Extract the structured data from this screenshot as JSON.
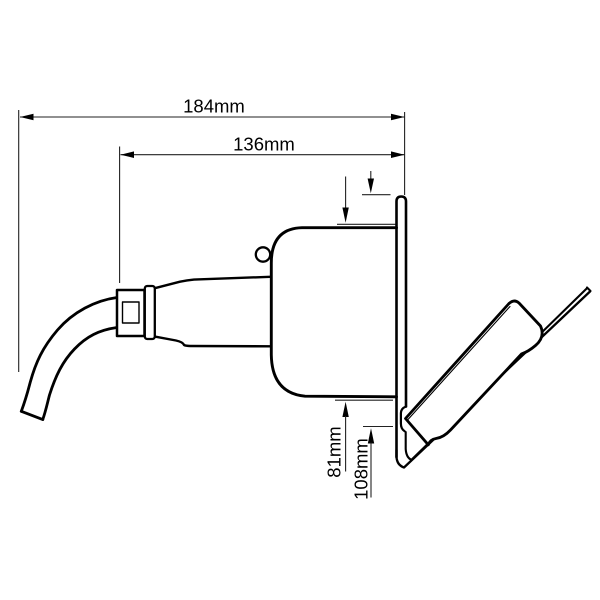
{
  "figure": {
    "type": "technical-line-drawing",
    "background": "#ffffff",
    "line_color": "#000000",
    "dimension_line_color": "#222222",
    "dimensions": {
      "overall_length": {
        "label": "184mm",
        "orientation": "horizontal"
      },
      "body_length": {
        "label": "136mm",
        "orientation": "horizontal"
      },
      "body_height": {
        "label": "81mm",
        "orientation": "vertical"
      },
      "flange_height": {
        "label": "108mm",
        "orientation": "vertical"
      }
    }
  }
}
